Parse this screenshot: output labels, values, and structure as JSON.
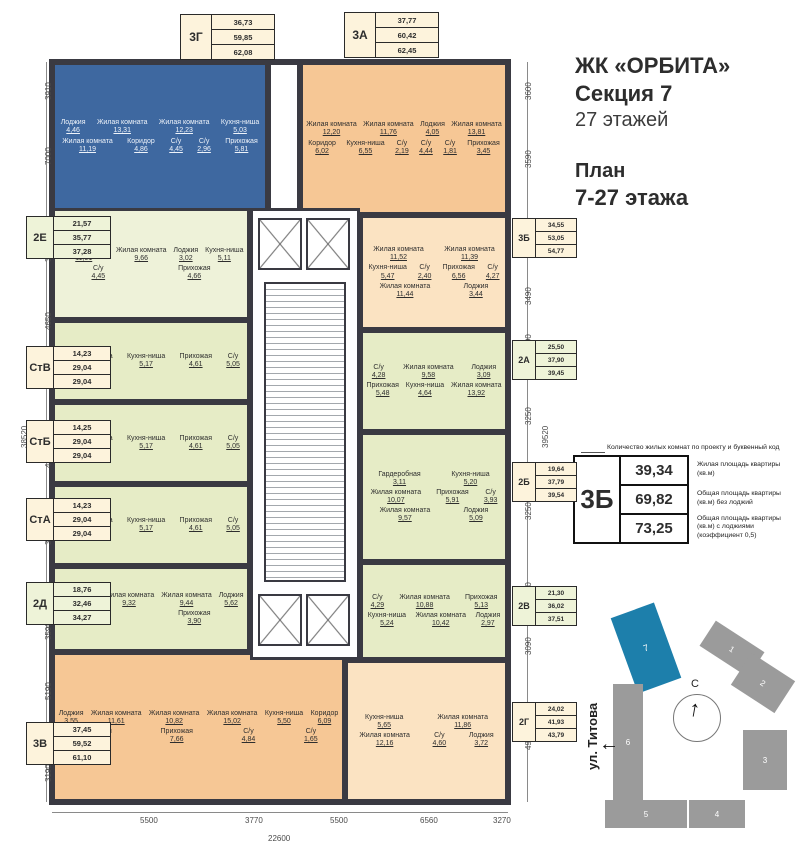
{
  "header": {
    "title": "ЖК «ОРБИТА»",
    "section": "Секция 7",
    "floors": "27 этажей",
    "plan_line1": "План",
    "plan_line2": "7-27 этажа"
  },
  "legend": {
    "note": "Количество жилых комнат по проекту и буквенный код",
    "code": "3Б",
    "rows": [
      {
        "value": "39,34",
        "desc": "Жилая площадь квартиры (кв.м)"
      },
      {
        "value": "69,82",
        "desc": "Общая площадь квартиры (кв.м) без лоджий"
      },
      {
        "value": "73,25",
        "desc": "Общая площадь квартиры (кв.м) с лоджиями (коэффициент 0,5)"
      }
    ]
  },
  "apartments": [
    {
      "code": "3Г",
      "palette": "blue",
      "box_palette": "cream",
      "areas": [
        "36,73",
        "59,85",
        "62,08"
      ],
      "rooms": [
        {
          "name": "Лоджия",
          "area": "4,46"
        },
        {
          "name": "Жилая комната",
          "area": "13,31"
        },
        {
          "name": "Жилая комната",
          "area": "12,23"
        },
        {
          "name": "Кухня-ниша",
          "area": "5,03"
        },
        {
          "name": "Жилая комната",
          "area": "11,19"
        },
        {
          "name": "Коридор",
          "area": "4,86"
        },
        {
          "name": "С/у",
          "area": "4,45"
        },
        {
          "name": "С/у",
          "area": "2,96"
        },
        {
          "name": "Прихожая",
          "area": "5,81"
        }
      ]
    },
    {
      "code": "3А",
      "palette": "orange",
      "box_palette": "cream",
      "areas": [
        "37,77",
        "60,42",
        "62,45"
      ],
      "rooms": [
        {
          "name": "Жилая комната",
          "area": "12,20"
        },
        {
          "name": "Жилая комната",
          "area": "11,76"
        },
        {
          "name": "Лоджия",
          "area": "4,05"
        },
        {
          "name": "Жилая комната",
          "area": "13,81"
        },
        {
          "name": "Коридор",
          "area": "6,02"
        },
        {
          "name": "Кухня-ниша",
          "area": "6,55"
        },
        {
          "name": "С/у",
          "area": "2,19"
        },
        {
          "name": "С/у",
          "area": "4,44"
        },
        {
          "name": "С/у",
          "area": "1,81"
        },
        {
          "name": "Прихожая",
          "area": "3,45"
        }
      ]
    },
    {
      "code": "3Б",
      "palette": "cream",
      "box_palette": "cream",
      "areas": [
        "34,55",
        "53,05",
        "54,77"
      ],
      "rooms": [
        {
          "name": "Жилая комната",
          "area": "11,52"
        },
        {
          "name": "Жилая комната",
          "area": "11,39"
        },
        {
          "name": "Кухня-ниша",
          "area": "5,47"
        },
        {
          "name": "С/у",
          "area": "2,40"
        },
        {
          "name": "Прихожая",
          "area": "6,56"
        },
        {
          "name": "С/у",
          "area": "4,27"
        },
        {
          "name": "Жилая комната",
          "area": "11,44"
        },
        {
          "name": "Лоджия",
          "area": "3,44"
        }
      ]
    },
    {
      "code": "2А",
      "palette": "green",
      "box_palette": "green",
      "areas": [
        "25,50",
        "37,90",
        "39,45"
      ],
      "rooms": [
        {
          "name": "С/у",
          "area": "4,28"
        },
        {
          "name": "Жилая комната",
          "area": "9,58"
        },
        {
          "name": "Лоджия",
          "area": "3,09"
        },
        {
          "name": "Прихожая",
          "area": "5,48"
        },
        {
          "name": "Кухня-ниша",
          "area": "4,64"
        },
        {
          "name": "Жилая комната",
          "area": "13,92"
        }
      ]
    },
    {
      "code": "2Б",
      "palette": "green",
      "box_palette": "cream",
      "areas": [
        "19,64",
        "37,79",
        "39,54"
      ],
      "rooms": [
        {
          "name": "Гардеробная",
          "area": "3,11"
        },
        {
          "name": "Кухня-ниша",
          "area": "5,20"
        },
        {
          "name": "Жилая комната",
          "area": "10,07"
        },
        {
          "name": "Прихожая",
          "area": "5,91"
        },
        {
          "name": "С/у",
          "area": "3,93"
        },
        {
          "name": "Жилая комната",
          "area": "9,57"
        },
        {
          "name": "Лоджия",
          "area": "5,09"
        }
      ]
    },
    {
      "code": "2В",
      "palette": "green",
      "box_palette": "green",
      "areas": [
        "21,30",
        "36,02",
        "37,51"
      ],
      "rooms": [
        {
          "name": "С/у",
          "area": "4,29"
        },
        {
          "name": "Жилая комната",
          "area": "10,88"
        },
        {
          "name": "Прихожая",
          "area": "5,13"
        },
        {
          "name": "Кухня-ниша",
          "area": "5,24"
        },
        {
          "name": "Жилая комната",
          "area": "10,42"
        },
        {
          "name": "Лоджия",
          "area": "2,97"
        }
      ]
    },
    {
      "code": "2Г",
      "palette": "cream",
      "box_palette": "cream",
      "areas": [
        "24,02",
        "41,93",
        "43,79"
      ],
      "rooms": [
        {
          "name": "Кухня-ниша",
          "area": "5,65"
        },
        {
          "name": "Жилая комната",
          "area": "11,86"
        },
        {
          "name": "Жилая комната",
          "area": "12,16"
        },
        {
          "name": "С/у",
          "area": "4,60"
        },
        {
          "name": "Лоджия",
          "area": "3,72"
        }
      ]
    },
    {
      "code": "2Е",
      "palette": "lightgreen",
      "box_palette": "green",
      "areas": [
        "21,57",
        "35,77",
        "37,28"
      ],
      "rooms": [
        {
          "name": "Жилая комната",
          "area": "11,91"
        },
        {
          "name": "Жилая комната",
          "area": "9,66"
        },
        {
          "name": "Лоджия",
          "area": "3,02"
        },
        {
          "name": "Кухня-ниша",
          "area": "5,11"
        },
        {
          "name": "С/у",
          "area": "4,45"
        },
        {
          "name": "Прихожая",
          "area": "4,66"
        }
      ]
    },
    {
      "code": "СтВ",
      "palette": "green",
      "box_palette": "cream",
      "areas": [
        "14,23",
        "29,04",
        "29,04"
      ],
      "rooms": [
        {
          "name": "Жилая комната",
          "area": "14,23"
        },
        {
          "name": "Кухня-ниша",
          "area": "5,17"
        },
        {
          "name": "Прихожая",
          "area": "4,61"
        },
        {
          "name": "С/у",
          "area": "5,05"
        }
      ]
    },
    {
      "code": "СтБ",
      "palette": "green",
      "box_palette": "cream",
      "areas": [
        "14,25",
        "29,04",
        "29,04"
      ],
      "rooms": [
        {
          "name": "Жилая комната",
          "area": "14,25"
        },
        {
          "name": "Кухня-ниша",
          "area": "5,17"
        },
        {
          "name": "Прихожая",
          "area": "4,61"
        },
        {
          "name": "С/у",
          "area": "5,05"
        }
      ]
    },
    {
      "code": "СтА",
      "palette": "green",
      "box_palette": "cream",
      "areas": [
        "14,23",
        "29,04",
        "29,04"
      ],
      "rooms": [
        {
          "name": "Жилая комната",
          "area": "14,23"
        },
        {
          "name": "Кухня-ниша",
          "area": "5,17"
        },
        {
          "name": "Прихожая",
          "area": "4,61"
        },
        {
          "name": "С/у",
          "area": "5,05"
        }
      ]
    },
    {
      "code": "2Д",
      "palette": "green",
      "box_palette": "green",
      "areas": [
        "18,76",
        "32,46",
        "34,27"
      ],
      "rooms": [
        {
          "name": "Кухня-ниша",
          "area": "5,25"
        },
        {
          "name": "Жилая комната",
          "area": "9,32"
        },
        {
          "name": "Жилая комната",
          "area": "9,44"
        },
        {
          "name": "Лоджия",
          "area": "5,62"
        },
        {
          "name": "С/у",
          "area": "4,55"
        },
        {
          "name": "Прихожая",
          "area": "3,90"
        }
      ]
    },
    {
      "code": "3В",
      "palette": "orange",
      "box_palette": "cream",
      "areas": [
        "37,45",
        "59,52",
        "61,10"
      ],
      "rooms": [
        {
          "name": "Лоджия",
          "area": "3,55"
        },
        {
          "name": "Жилая комната",
          "area": "11,61"
        },
        {
          "name": "Жилая комната",
          "area": "10,82"
        },
        {
          "name": "Жилая комната",
          "area": "15,02"
        },
        {
          "name": "Кухня-ниша",
          "area": "5,50"
        },
        {
          "name": "Коридор",
          "area": "6,09"
        },
        {
          "name": "Прихожая",
          "area": "5,79"
        },
        {
          "name": "Прихожая",
          "area": "7,66"
        },
        {
          "name": "С/у",
          "area": "4,84"
        },
        {
          "name": "С/у",
          "area": "1,65"
        }
      ]
    }
  ],
  "dims": {
    "left": [
      "3910",
      "7000",
      "3090",
      "4650",
      "4650",
      "3850",
      "3590",
      "5190",
      "3190"
    ],
    "left_total": "38520",
    "right": [
      "3600",
      "3590",
      "3650",
      "3490",
      "3190",
      "3250",
      "3250",
      "3190",
      "3090",
      "4970"
    ],
    "right_total": "39520",
    "bottom": [
      "5500",
      "3770",
      "5500",
      "6560",
      "3270"
    ],
    "bottom_total": "22600"
  },
  "site_plan": {
    "street": "ул. Титова",
    "compass": "С",
    "buildings": [
      "1",
      "2",
      "3",
      "4",
      "5",
      "6",
      "7"
    ],
    "highlighted_building": "7"
  },
  "colors": {
    "wall": "#3a3a42",
    "apartment_blue": "#3e68a0",
    "apartment_orange": "#f6c795",
    "apartment_cream": "#fbe3c2",
    "apartment_green": "#e6ecc6",
    "apartment_lightgreen": "#eef2d9",
    "site_building_gray": "#9b9b9b",
    "site_building_highlight": "#1d7fab"
  }
}
